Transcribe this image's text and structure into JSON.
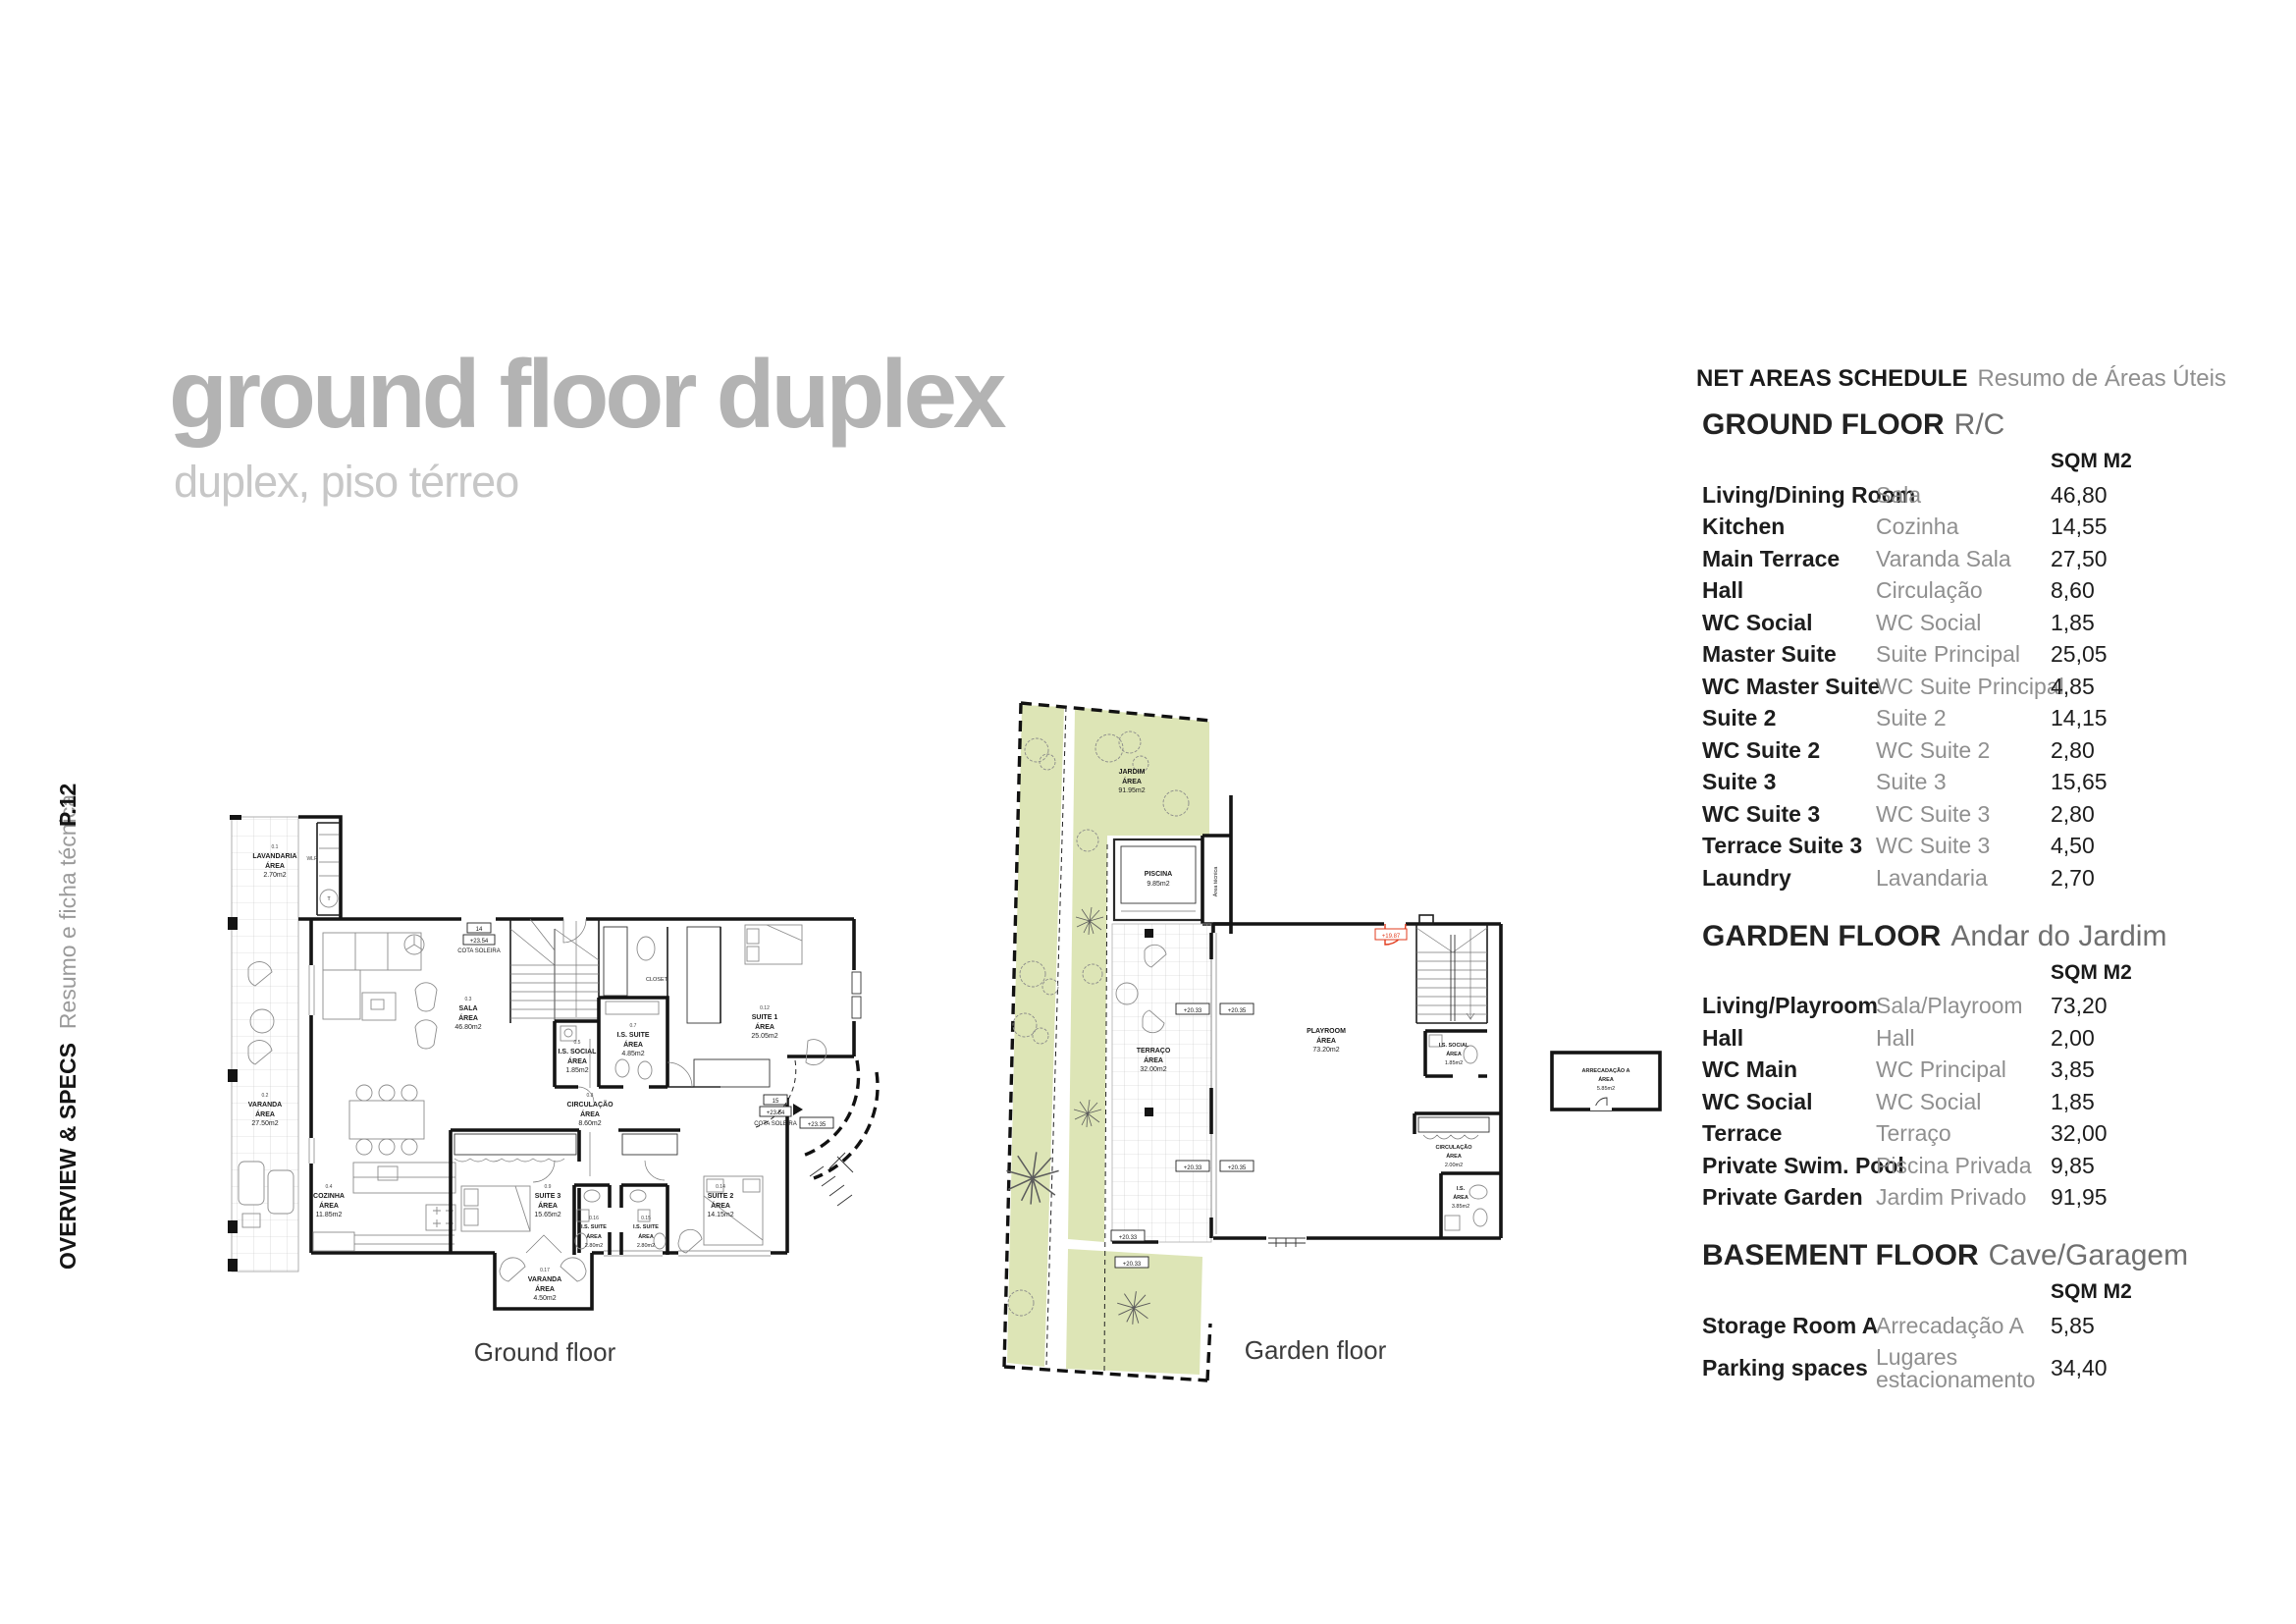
{
  "page": {
    "title": "ground floor duplex",
    "subtitle": "duplex, piso térreo",
    "page_number": "P.12",
    "sidebar_title": "OVERVIEW & SPECS",
    "sidebar_subtitle": "Resumo e ficha técnica"
  },
  "area_label": "ÁREA",
  "plans": {
    "ground": {
      "caption": "Ground floor",
      "labels": {
        "lavandaria": {
          "code": "0.1",
          "name": "LAVANDARIA",
          "value": "2.70m2"
        },
        "varanda": {
          "code": "0.2",
          "name": "VARANDA",
          "value": "27.50m2"
        },
        "sala": {
          "code": "0.3",
          "name": "SALA",
          "value": "46.80m2"
        },
        "cozinha": {
          "code": "0.4",
          "name": "COZINHA",
          "value": "11.85m2"
        },
        "is_social": {
          "code": "0.5",
          "name": "I.S. SOCIAL",
          "value": "1.85m2"
        },
        "is_suite": {
          "code": "0.7",
          "name": "I.S. SUITE",
          "value": "4.85m2"
        },
        "circulacao": {
          "code": "0.8",
          "name": "CIRCULAÇÃO",
          "value": "8.60m2"
        },
        "suite3": {
          "code": "0.9",
          "name": "SUITE 3",
          "value": "15.65m2"
        },
        "suite1": {
          "code": "0.12",
          "name": "SUITE 1",
          "value": "25.05m2"
        },
        "suite2": {
          "code": "0.14",
          "name": "SUITE 2",
          "value": "14.15m2"
        },
        "is_suite15": {
          "code": "0.15",
          "name": "I.S. SUITE",
          "value": "2.80m2"
        },
        "is_suite16": {
          "code": "0.16",
          "name": "I.S. SUITE",
          "value": "2.80m2"
        },
        "varanda17": {
          "code": "0.17",
          "name": "VARANDA",
          "value": "4.50m2"
        },
        "closet": "CLOSET",
        "wlr": "WLR",
        "t": "T",
        "cota14": {
          "num": "14",
          "level": "+23.54",
          "text": "COTA SOLEIRA"
        },
        "cota15": {
          "num": "15",
          "level": "+23.54",
          "text": "COTA SOLEIRA"
        },
        "level2335": "+23.35"
      }
    },
    "garden": {
      "caption": "Garden floor",
      "labels": {
        "jardim": {
          "name": "JARDIM",
          "value": "91.95m2"
        },
        "piscina": {
          "name": "PISCINA",
          "value": "9.85m2"
        },
        "terraco": {
          "name": "TERRAÇO",
          "value": "32.00m2"
        },
        "playroom": {
          "name": "PLAYROOM",
          "value": "73.20m2"
        },
        "is_social": {
          "name": "I.S. SOCIAL",
          "value": "1.85m2"
        },
        "circulacao": {
          "name": "CIRCULAÇÃO",
          "value": "2.00m2"
        },
        "is": {
          "name": "I.S.",
          "value": "3.85m2"
        },
        "arrecadacao": {
          "name": "ARRECADAÇÃO A",
          "value": "5.85m2"
        },
        "area_tecnica": "Área técnica",
        "lv2033": "+20.33",
        "lv2035": "+20.35",
        "lv1987": "+19.87"
      }
    }
  },
  "schedule": {
    "title_en": "NET AREAS SCHEDULE",
    "title_pt": "Resumo de Áreas Úteis",
    "sqm_label": "SQM M2",
    "sections": [
      {
        "heading_en": "GROUND FLOOR",
        "heading_pt": "R/C",
        "rows": [
          {
            "en": "Living/Dining Room",
            "pt": "Sala",
            "sqm": "46,80"
          },
          {
            "en": "Kitchen",
            "pt": "Cozinha",
            "sqm": "14,55"
          },
          {
            "en": "Main Terrace",
            "pt": "Varanda Sala",
            "sqm": "27,50"
          },
          {
            "en": "Hall",
            "pt": "Circulação",
            "sqm": "8,60"
          },
          {
            "en": "WC Social",
            "pt": "WC Social",
            "sqm": "1,85"
          },
          {
            "en": "Master Suite",
            "pt": "Suite Principal",
            "sqm": "25,05"
          },
          {
            "en": "WC Master Suite",
            "pt": "WC Suite Principal",
            "sqm": "4,85"
          },
          {
            "en": "Suite 2",
            "pt": "Suite 2",
            "sqm": "14,15"
          },
          {
            "en": "WC Suite 2",
            "pt": "WC Suite 2",
            "sqm": "2,80"
          },
          {
            "en": "Suite 3",
            "pt": "Suite 3",
            "sqm": "15,65"
          },
          {
            "en": "WC Suite 3",
            "pt": "WC Suite 3",
            "sqm": "2,80"
          },
          {
            "en": "Terrace Suite 3",
            "pt": "WC Suite 3",
            "sqm": "4,50"
          },
          {
            "en": "Laundry",
            "pt": "Lavandaria",
            "sqm": "2,70"
          }
        ]
      },
      {
        "heading_en": "GARDEN FLOOR",
        "heading_pt": "Andar do Jardim",
        "rows": [
          {
            "en": "Living/Playroom",
            "pt": "Sala/Playroom",
            "sqm": "73,20"
          },
          {
            "en": "Hall",
            "pt": "Hall",
            "sqm": "2,00"
          },
          {
            "en": "WC Main",
            "pt": "WC Principal",
            "sqm": "3,85"
          },
          {
            "en": "WC Social",
            "pt": "WC Social",
            "sqm": "1,85"
          },
          {
            "en": "Terrace",
            "pt": "Terraço",
            "sqm": "32,00"
          },
          {
            "en": "Private Swim. Pool",
            "pt": "Piscina Privada",
            "sqm": "9,85"
          },
          {
            "en": "Private Garden",
            "pt": "Jardim Privado",
            "sqm": "91,95"
          }
        ]
      },
      {
        "heading_en": "BASEMENT FLOOR",
        "heading_pt": "Cave/Garagem",
        "rows": [
          {
            "en": "Storage Room A",
            "pt": "Arrecadação A",
            "sqm": "5,85"
          },
          {
            "en": "Parking spaces",
            "pt": "Lugares estacionamento",
            "sqm": "34,40"
          }
        ]
      }
    ]
  }
}
